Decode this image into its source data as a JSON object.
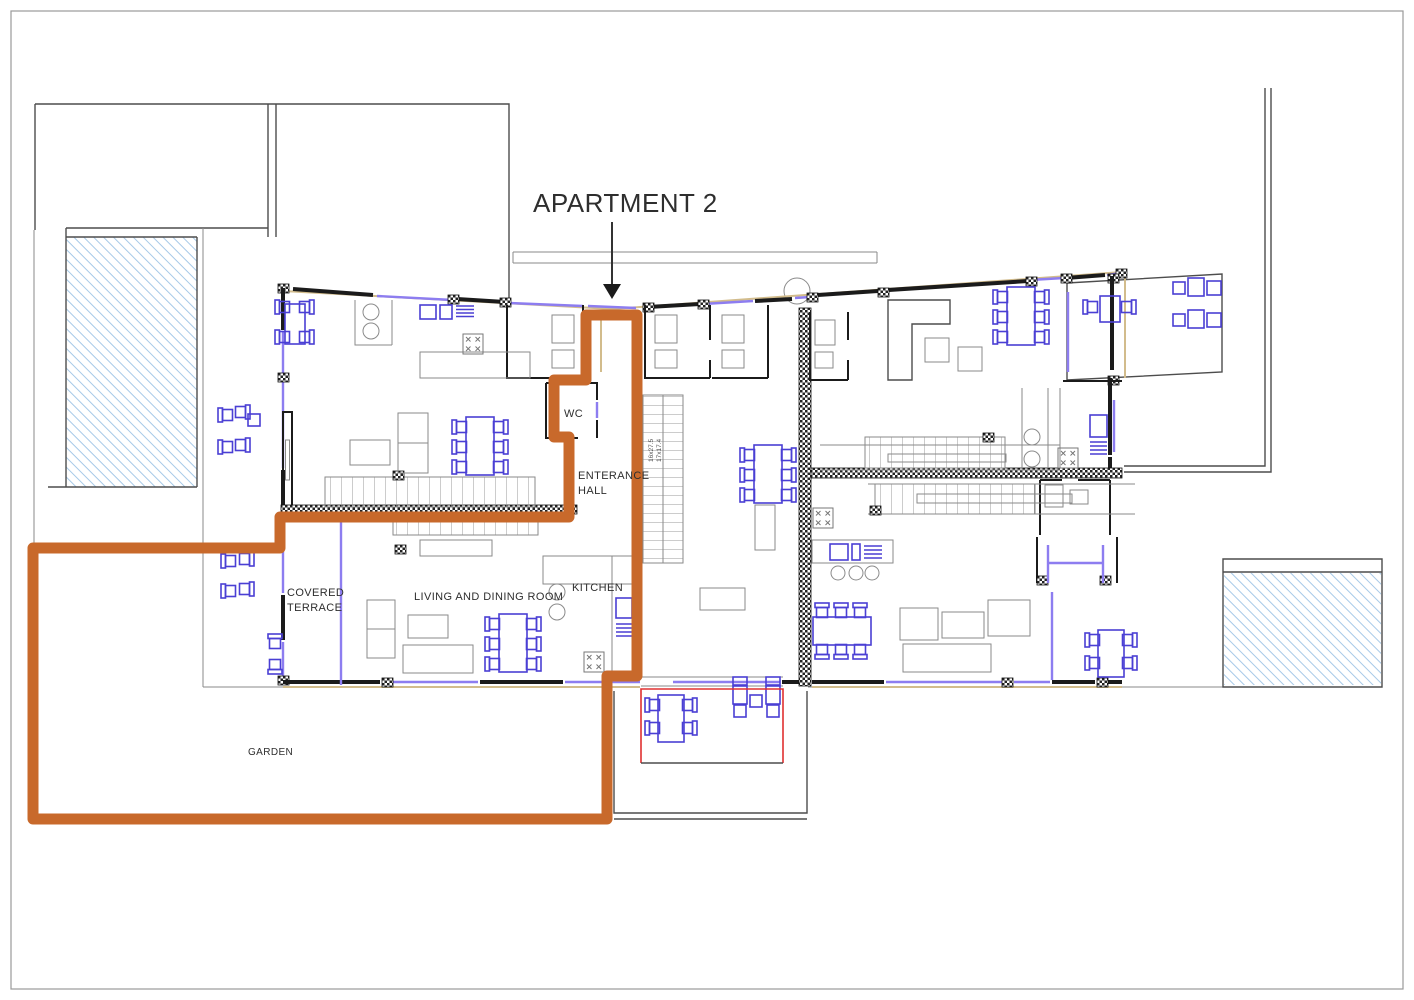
{
  "page": {
    "type": "architectural-floor-plan"
  },
  "title": {
    "label": "APARTMENT 2"
  },
  "labels": {
    "wc": "WC",
    "entrance_hall_line1": "ENTERANCE",
    "entrance_hall_line2": "HALL",
    "kitchen": "KITCHEN",
    "living_dining": "LIVING AND DINING ROOM",
    "covered_terrace_line1": "COVERED",
    "covered_terrace_line2": "TERRACE",
    "garden": "GARDEN",
    "stair_dim_line1": "16x27.5",
    "stair_dim_line2": "17x17.4"
  },
  "colors": {
    "apartment_boundary": "#c8692b",
    "furniture": "#4a3fd4",
    "window": "#8d7df0",
    "wall": "#1b1b1b",
    "thin_line": "#8a8a8a",
    "outline": "#4d4d4d",
    "pool_hatch": "#9cc3e6",
    "terrace_marker": "#e03030",
    "wall_accent": "#d2bc8c",
    "text": "#2e2e2e"
  }
}
